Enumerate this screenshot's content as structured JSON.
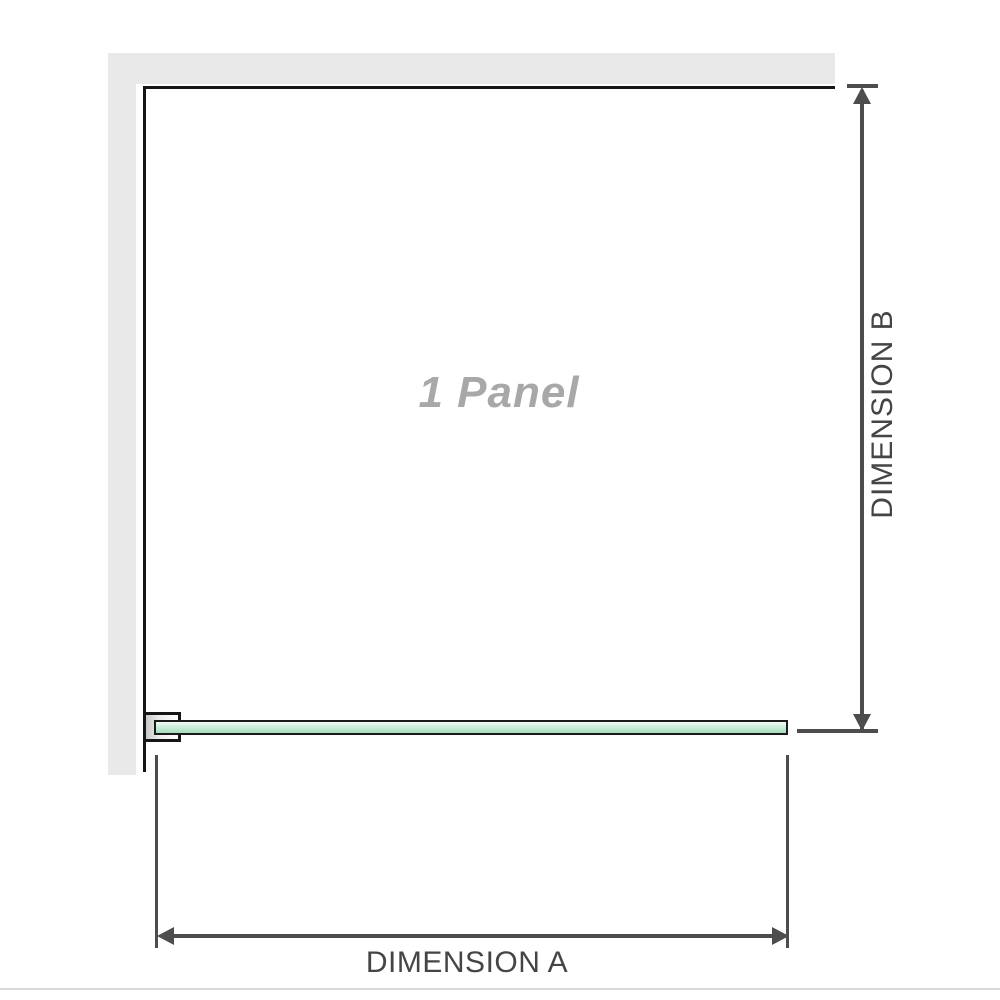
{
  "diagram": {
    "panel_label": "1 Panel",
    "dimension_a_label": "DIMENSION A",
    "dimension_b_label": "DIMENSION B",
    "colors": {
      "wall": "#e9e9e9",
      "outline": "#161616",
      "dim": "#4d4d4d",
      "dim-text": "#454545",
      "panel-text": "#a8a8a8",
      "glass-top": "#f2faf5",
      "glass-mid": "#cdeeda",
      "glass-bot": "#a6dcbe",
      "divider": "#d9d9d5",
      "bg": "#ffffff"
    }
  }
}
